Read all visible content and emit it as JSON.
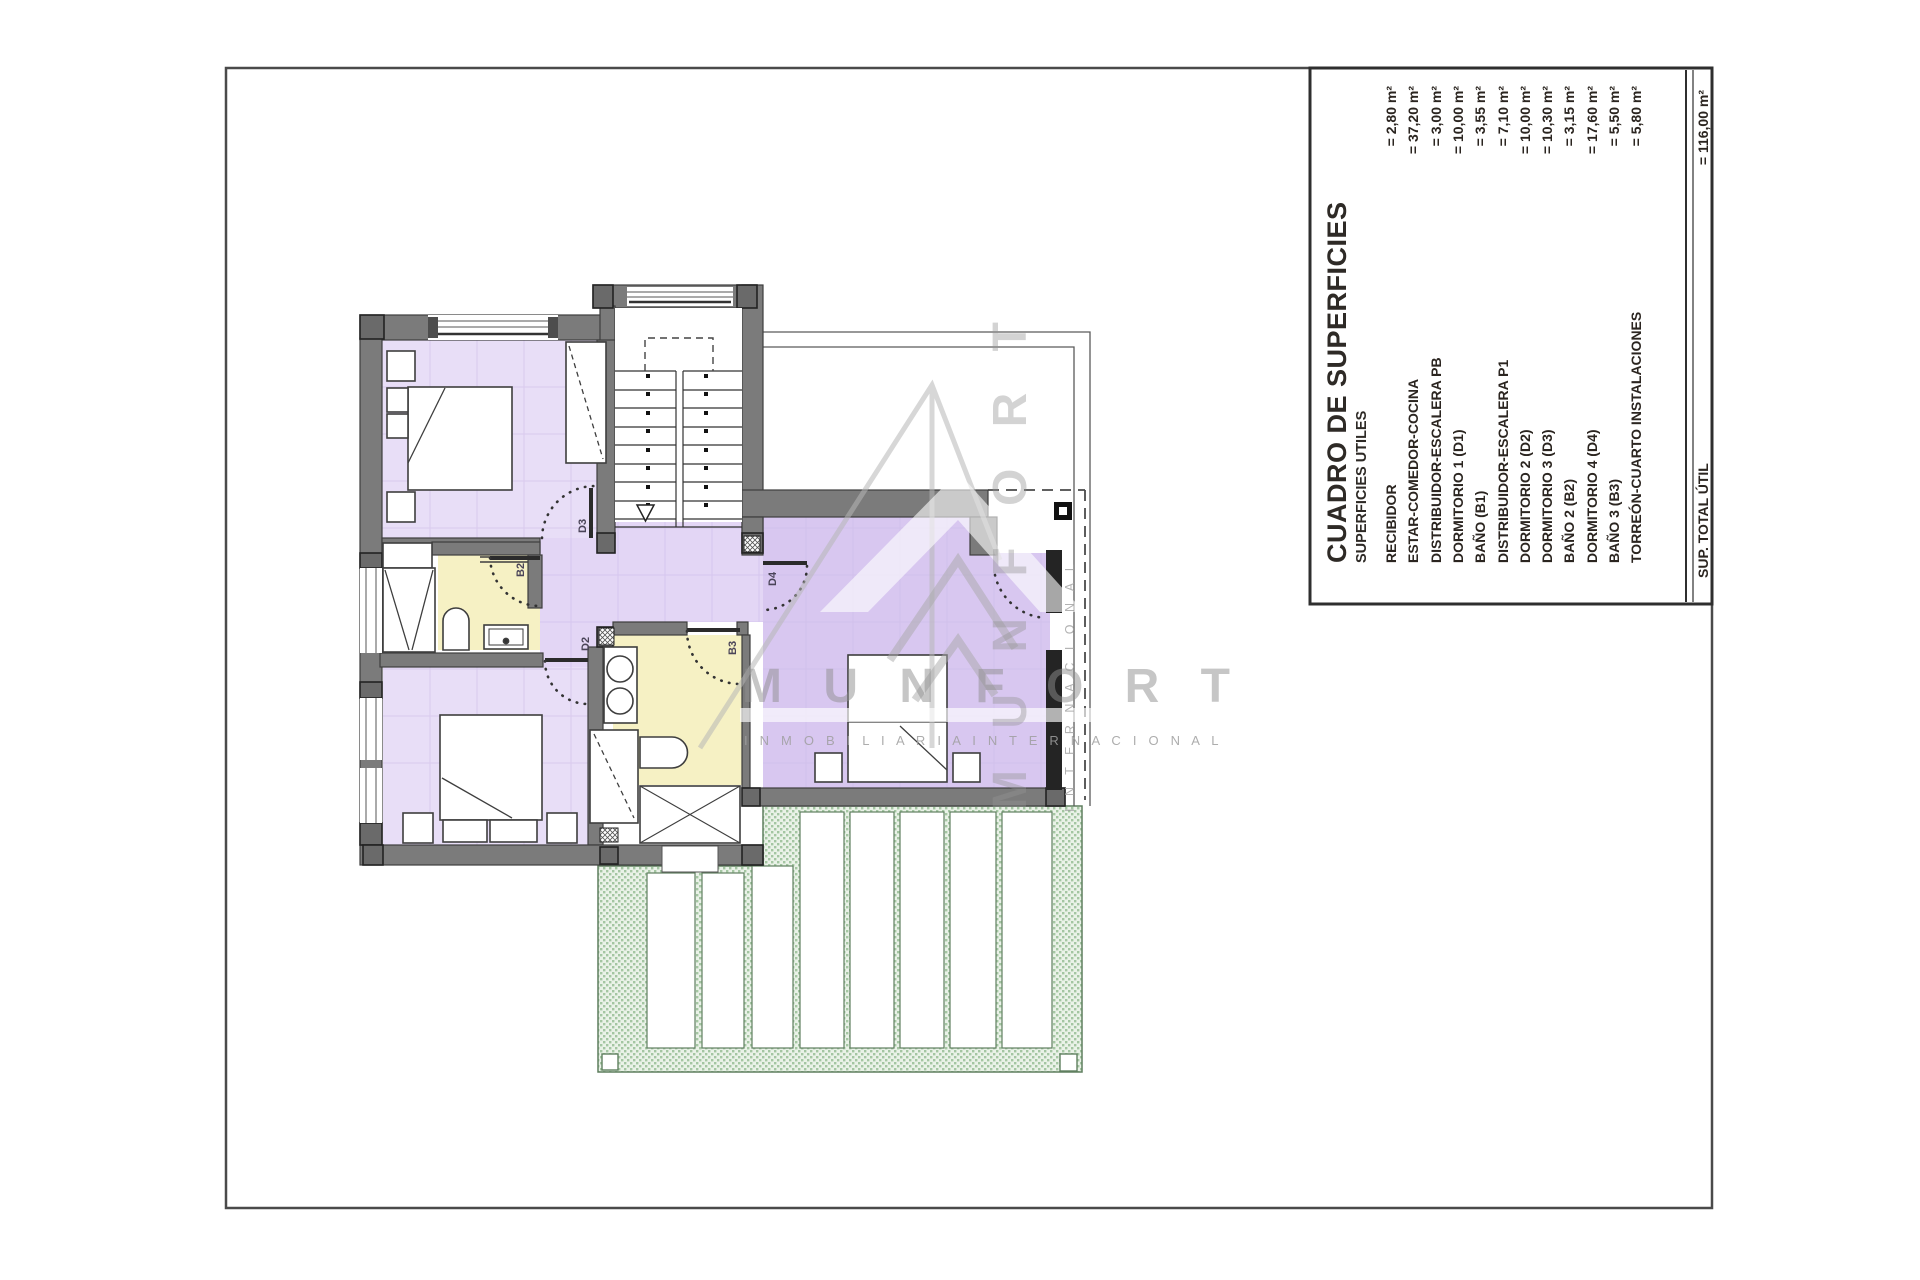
{
  "table": {
    "title": "CUADRO DE SUPERFICIES",
    "subtitle": "SUPERFICIES UTILES",
    "rows": [
      {
        "name": "RECIBIDOR",
        "value": "= 2,80 m²"
      },
      {
        "name": "ESTAR-COMEDOR-COCINA",
        "value": "= 37,20 m²"
      },
      {
        "name": "DISTRIBUIDOR-ESCALERA PB",
        "value": "= 3,00 m²"
      },
      {
        "name": "DORMITORIO 1 (D1)",
        "value": "= 10,00 m²"
      },
      {
        "name": "BAÑO  (B1)",
        "value": "= 3,55 m²"
      },
      {
        "name": "DISTRIBUIDOR-ESCALERA P1",
        "value": "= 7,10 m²"
      },
      {
        "name": "DORMITORIO 2 (D2)",
        "value": "= 10,00 m²"
      },
      {
        "name": "DORMITORIO 3 (D3)",
        "value": "= 10,30 m²"
      },
      {
        "name": "BAÑO 2 (B2)",
        "value": "= 3,15 m²"
      },
      {
        "name": "DORMITORIO 4 (D4)",
        "value": "= 17,60 m²"
      },
      {
        "name": "BAÑO 3 (B3)",
        "value": "= 5,50 m²"
      },
      {
        "name": "TORREÓN-CUARTO INSTALACIONES",
        "value": "= 5,80 m²"
      }
    ],
    "total": {
      "label": "SUP. TOTAL ÚTIL",
      "value": "= 116,00 m²"
    }
  },
  "plan": {
    "door_labels": {
      "d2": "D2",
      "d3": "D3",
      "d4": "D4",
      "b2": "B2",
      "b3": "B3"
    }
  },
  "watermark": {
    "brand_spaced": "M U N F O R T",
    "tagline_spaced": "I N M O B I L I A R I A      I N T E R N A C I O N A L",
    "vertical_brand": "M U N F O R T",
    "vertical_tagline": "I N T E R N A C I O N A L"
  },
  "colors": {
    "wall_gray": "#7b7b7b",
    "wall_edge": "#3e3e3e",
    "room_lilac": "#e8def7",
    "room_lilac_deep": "#d8c7f0",
    "bath_yellow": "#f6f1c4",
    "terrace_green": "#eaf2e8",
    "terrace_dot": "#a4c6a2",
    "terrace_edge": "#5f7f5f"
  }
}
